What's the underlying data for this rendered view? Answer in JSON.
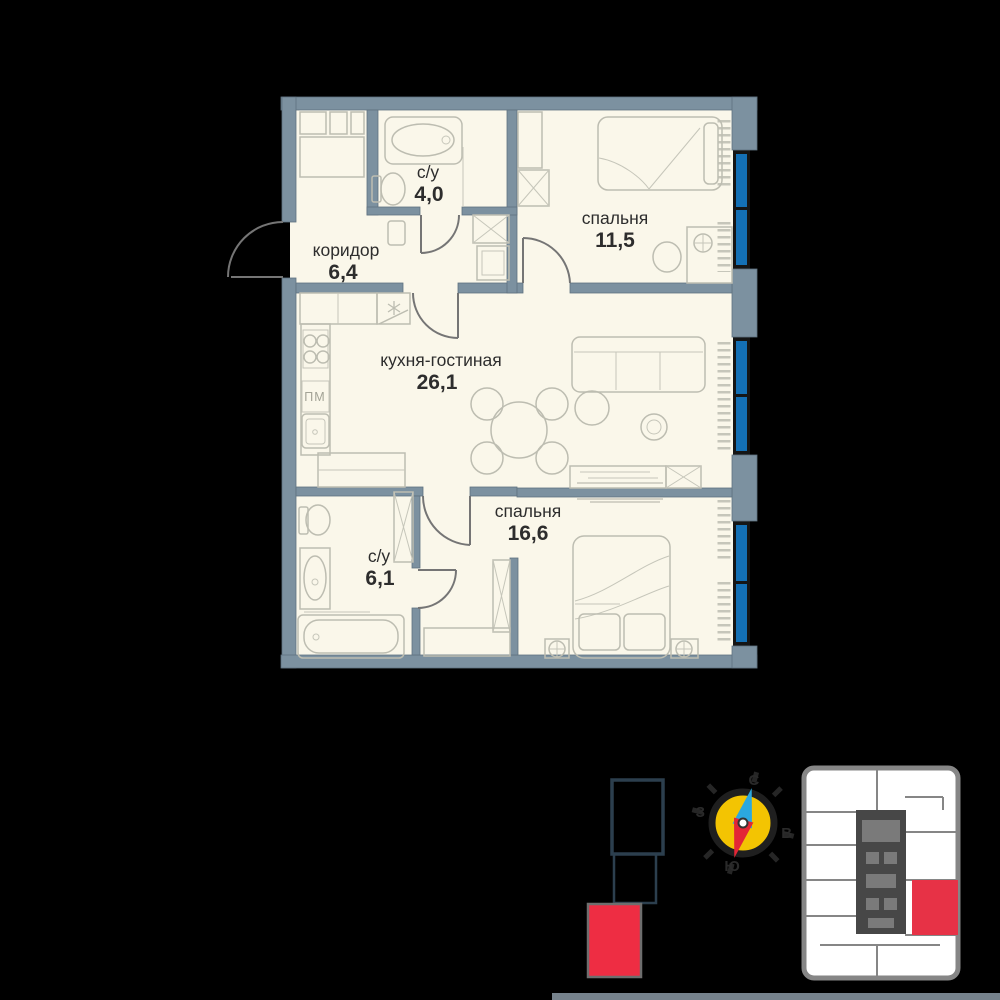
{
  "plan": {
    "rooms": [
      {
        "id": "bathroom-top",
        "name": "с/у",
        "area": "4,0"
      },
      {
        "id": "corridor",
        "name": "коридор",
        "area": "6,4"
      },
      {
        "id": "bedroom-1",
        "name": "спальня",
        "area": "11,5"
      },
      {
        "id": "kitchen-living",
        "name": "кухня-гостиная",
        "area": "26,1"
      },
      {
        "id": "bedroom-2",
        "name": "спальня",
        "area": "16,6"
      },
      {
        "id": "bathroom-bottom",
        "name": "с/у",
        "area": "6,1"
      }
    ],
    "kitchen": {
      "dishwasher_label": "ПМ"
    }
  },
  "compass": {
    "north": "С",
    "east": "В",
    "south": "Ю",
    "west": "З"
  },
  "colors": {
    "background": "#000000",
    "floor": "#faf7ea",
    "wall": "#7c91a0",
    "window_glass": "#1470b5",
    "highlight_red": "#ee2d43",
    "compass_yellow": "#f3c402",
    "keyplan_wall": "#868686"
  }
}
